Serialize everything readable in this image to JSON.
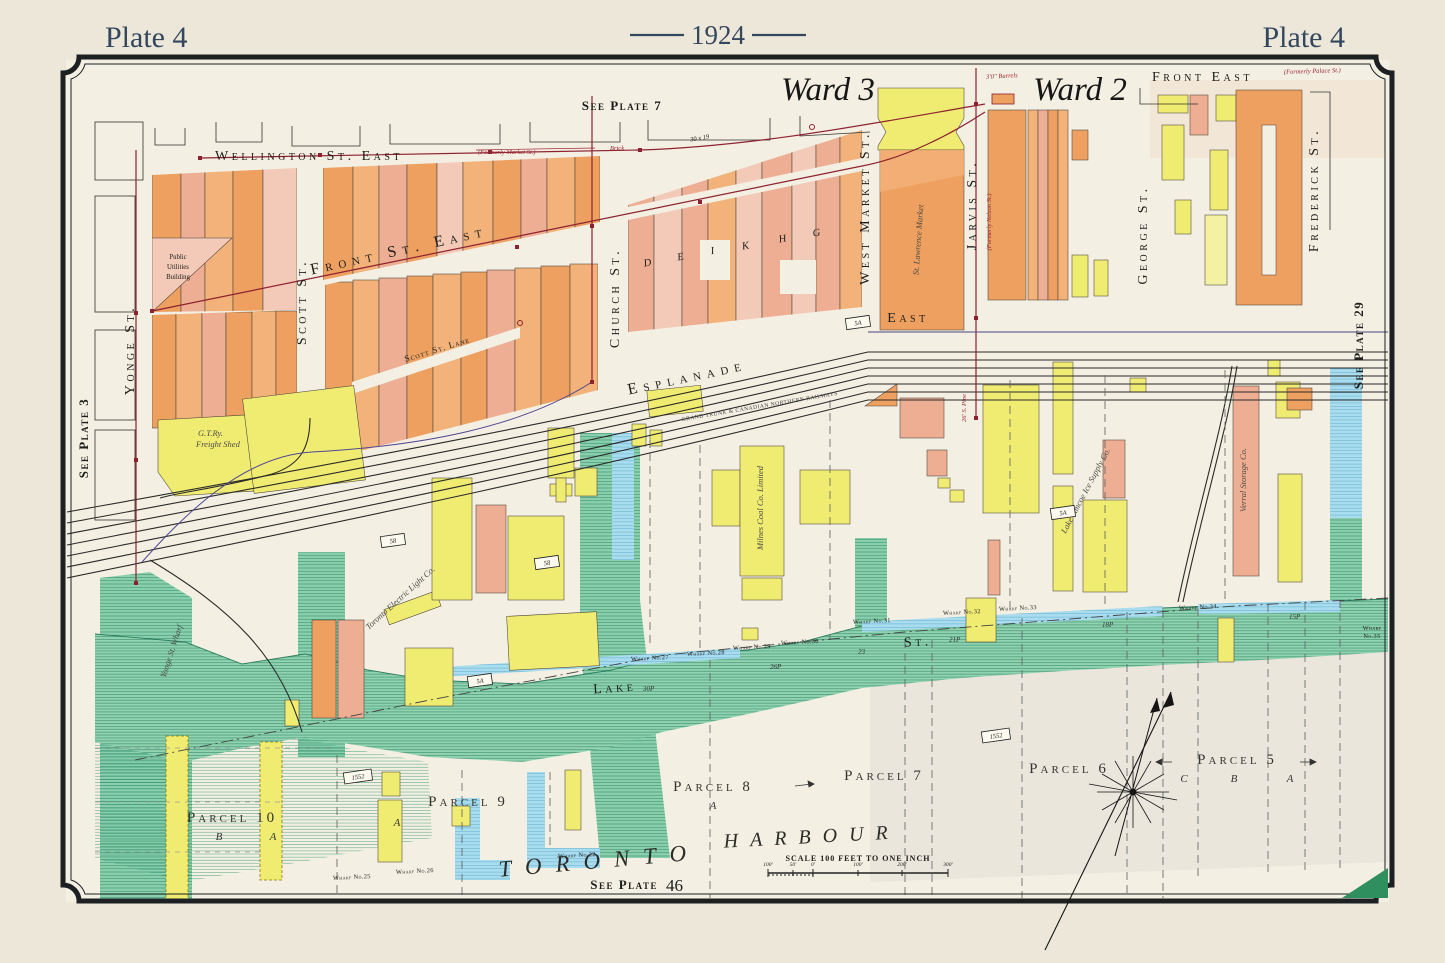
{
  "palette": {
    "paper": "#ece7d8",
    "map_bg": "#f3efe2",
    "ink": "#1d1d1b",
    "title_blue": "#33485e",
    "red_line": "#8e2130",
    "purple_line": "#4f4694",
    "building_orange": "#eda05f",
    "building_salmon": "#eeae93",
    "building_pink": "#f3c9b8",
    "building_yellow": "#f0ec72",
    "water_teal": "#8ad0ae",
    "water_blue": "#a8dcee",
    "shore_green": "#8fd3b0",
    "corner_green": "#2f8f5f"
  },
  "header": {
    "plate_left": "Plate 4",
    "year": "1924",
    "plate_right": "Plate 4"
  },
  "refs": {
    "top": "See Plate 7",
    "left": "See Plate 3",
    "right": "See Plate 29",
    "bottom": "See Plate",
    "bottom_num": "46"
  },
  "wards": {
    "ward3": "Ward 3",
    "ward2": "Ward 2",
    "barrels_note": "3'0\" Barrels"
  },
  "streets": {
    "wellington": "Wellington St. East",
    "wellington_formerly": "(Formerly Market St.)",
    "brick_note": "Brick",
    "front": "Front St. East",
    "front_east": "Front East",
    "front_east_formerly": "(Formerly Palace St.)",
    "yonge": "Yonge St.",
    "scott": "Scott St.",
    "scott_lane": "Scott St. Lane",
    "church": "Church St.",
    "esplanade": "Esplanade",
    "esplanade_east": "East",
    "west_market": "West Market St.",
    "jarvis": "Jarvis St.",
    "jarvis_formerly": "(Formerly Nelson St.)",
    "george": "George St.",
    "frederick": "Frederick St.",
    "lake": "Lake",
    "lake_st": "St."
  },
  "railway": {
    "note": "GRAND TRUNK & CANADIAN NORTHERN RAILWAYS"
  },
  "buildings": {
    "st_lawrence": "St. Lawrence Market",
    "gtr_1": "G.T.Ry.",
    "gtr_2": "Freight Shed",
    "pu_1": "Public",
    "pu_2": "Utilities",
    "pu_3": "Building",
    "toronto_electric": "Toronto Electric Light Co.",
    "milnes": "Milnes Coal Co. Limited",
    "lake_simcoe": "Lake Simcoe Ice Supply Co.",
    "verral": "Verral Storage Co.",
    "yonge_wharf": "Yonge St. Wharf",
    "block_letters": [
      "D",
      "E",
      "I",
      "K",
      "H",
      "G"
    ]
  },
  "parcels": {
    "p10": "Parcel 10",
    "p10_b": "B",
    "p10_a": "A",
    "p9": "Parcel 9",
    "p9_a": "A",
    "p8": "Parcel 8",
    "p8_a": "A",
    "p7": "Parcel 7",
    "p6": "Parcel 6",
    "p5": "Parcel 5",
    "p5_c": "C",
    "p5_b": "B",
    "p5_a": "A"
  },
  "harbour": {
    "toronto": "TORONTO",
    "harbour": "HARBOUR"
  },
  "scale": {
    "caption": "SCALE 100 FEET TO ONE INCH",
    "t0": "100'",
    "t1": "50'",
    "t2": "0'",
    "t3": "100'",
    "t4": "200'",
    "t5": "300'"
  },
  "wharves": {
    "w25": "Wharf No.25",
    "w26": "Wharf No.26",
    "w22": "Wharf No.22",
    "w27": "Wharf No.27",
    "w28": "Wharf No.28",
    "w29": "Wharf No.29",
    "w30": "Wharf No.30",
    "w31": "Wharf No.31",
    "w32": "Wharf No.32",
    "w33": "Wharf No.33",
    "w34": "Wharf No.34",
    "w35a": "Wharf",
    "w35b": "No.35"
  },
  "markers": {
    "m5a": "5A",
    "m58": "58",
    "plan": "1552",
    "pipe": "26' S. Pipe",
    "dim": "30 x 19"
  },
  "depths": {
    "d30": "30P",
    "d26": "26P",
    "d23": "23",
    "d21": "21P",
    "d18": "18P",
    "d15": "15P"
  }
}
